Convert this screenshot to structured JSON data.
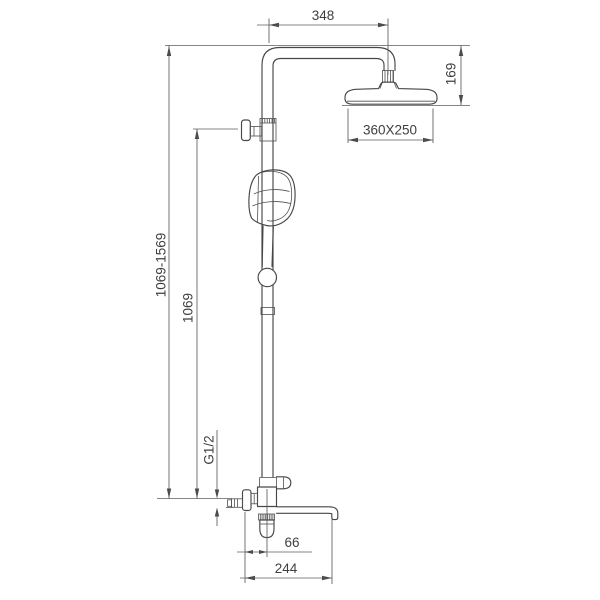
{
  "drawing": {
    "background_color": "#ffffff",
    "line_color": "#474747",
    "dimension_line_color": "#5c5c5c",
    "text_color": "#3f3f3f",
    "labels": {
      "arm_reach": "348",
      "head_drop": "169",
      "head_size": "360X250",
      "height_range": "1069-1569",
      "riser_height": "1069",
      "inlet_thread": "G1/2",
      "wall_offset": "66",
      "spout_reach": "244"
    }
  }
}
